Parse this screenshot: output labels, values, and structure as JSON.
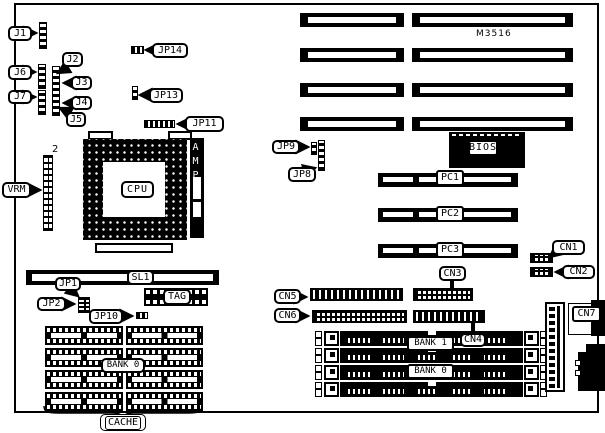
{
  "diagram": {
    "model": "M3516",
    "cpu": {
      "label": "CPU",
      "amp": "AMP"
    },
    "vrm": {
      "label": "VRM",
      "pin2": "2"
    },
    "jumpers": {
      "j1": "J1",
      "j2": "J2",
      "j3": "J3",
      "j4": "J4",
      "j5": "J5",
      "j6": "J6",
      "j7": "J7",
      "jp1": "JP1",
      "jp2": "JP2",
      "jp8": "JP8",
      "jp9": "JP9",
      "jp10": "JP10",
      "jp11": "JP11",
      "jp13": "JP13",
      "jp14": "JP14"
    },
    "slots": {
      "sl1": "SL1",
      "pc1": "PC1",
      "pc2": "PC2",
      "pc3": "PC3"
    },
    "bios": "BIOS",
    "connectors": {
      "cn1": "CN1",
      "cn2": "CN2",
      "cn3": "CN3",
      "cn4": "CN4",
      "cn5": "CN5",
      "cn6": "CN6",
      "cn7": "CN7"
    },
    "memory": {
      "bank1": "BANK 1",
      "bank0": "BANK 0"
    },
    "cache": {
      "bank0": "BANK 0",
      "tag": "TAG",
      "label": "CACHE"
    }
  }
}
